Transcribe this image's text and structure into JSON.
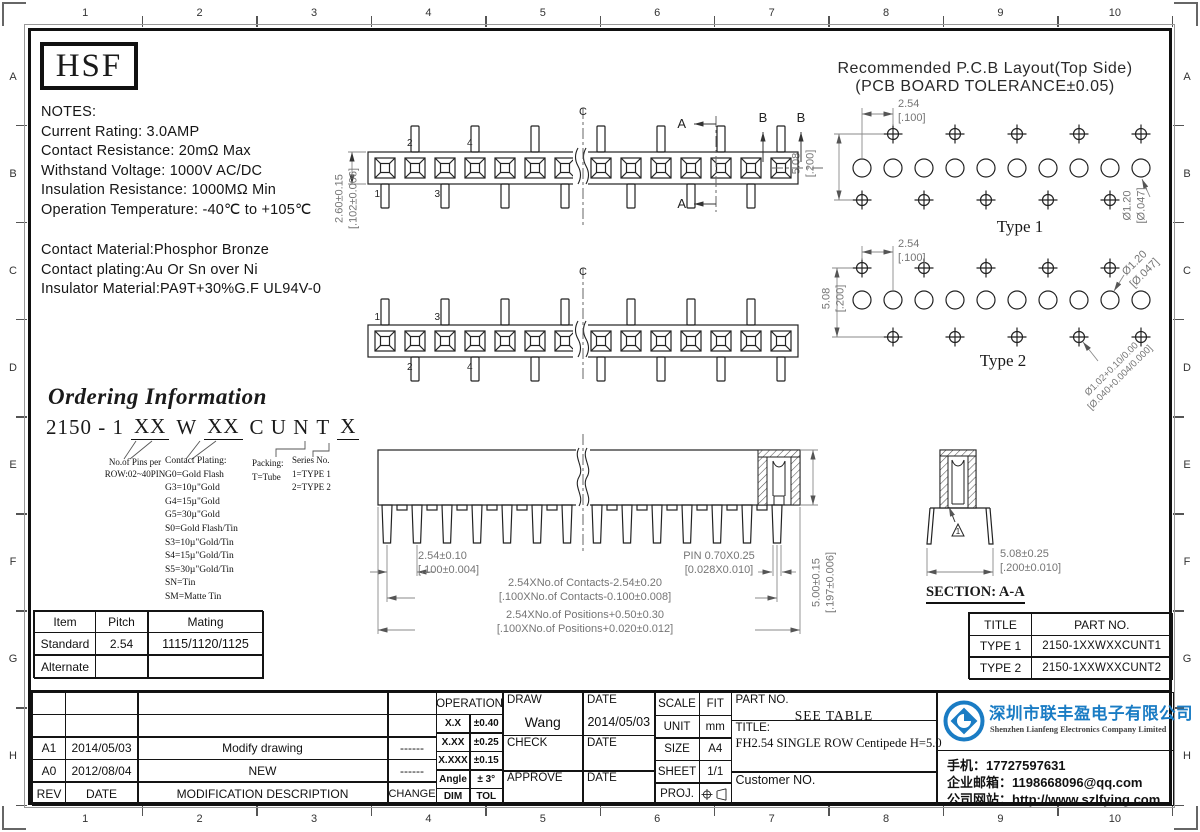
{
  "ruler": {
    "cols": [
      "1",
      "2",
      "3",
      "4",
      "5",
      "6",
      "7",
      "8",
      "9",
      "10"
    ],
    "rows": [
      "A",
      "B",
      "C",
      "D",
      "E",
      "F",
      "G",
      "H"
    ]
  },
  "logo_text": "HSF",
  "notes": {
    "heading": "NOTES:",
    "lines": [
      "Current Rating: 3.0AMP",
      "Contact Resistance: 20mΩ Max",
      "Withstand Voltage: 1000V AC/DC",
      "Insulation Resistance: 1000MΩ Min",
      "Operation Temperature: -40℃ to +105℃"
    ],
    "materials": [
      "Contact Material:Phosphor Bronze",
      "Contact plating:Au Or Sn over Ni",
      "Insulator Material:PA9T+30%G.F UL94V-0"
    ]
  },
  "pcb": {
    "title": "Recommended P.C.B Layout(Top Side)",
    "subtitle": "(PCB BOARD TOLERANCE±0.05)",
    "type1": {
      "label": "Type 1",
      "pitch": "2.54",
      "pitch_in": "[.100]",
      "row": "5.08",
      "row_in": "[.200]",
      "hole": "Ø1.20",
      "hole_in": "[Ø.047]"
    },
    "type2": {
      "label": "Type 2",
      "pitch": "2.54",
      "pitch_in": "[.100]",
      "row": "5.08",
      "row_in": "[.200]",
      "hole": "Ø1.20",
      "hole_in": "[Ø.047]",
      "hole2": "Ø1.02+0.10/0.00",
      "hole2_in": "[Ø.040+0.004/0.000]"
    }
  },
  "views": {
    "v1": {
      "height": "2.60±0.15",
      "height_in": "[.102±0.006]",
      "pins_top": [
        "2",
        "4"
      ],
      "pins_bottom": [
        "1",
        "3"
      ],
      "cl": "C",
      "sa": "A",
      "sb": "B"
    },
    "v2": {
      "pins_top": [
        "1",
        "3"
      ],
      "pins_bottom": [
        "2",
        "4"
      ],
      "cl": "C"
    }
  },
  "ordering": {
    "title": "Ordering Information",
    "code": [
      "2150 - 1",
      "XX",
      "W",
      "XX",
      "C U N",
      "T",
      "X"
    ],
    "pins_note": [
      "No.of Pins per",
      "ROW:02~40PIN"
    ],
    "plating_heading": "Contact Plating:",
    "plating": [
      "G0=Gold Flash",
      "G3=10µ\"Gold",
      "G4=15µ\"Gold",
      "G5=30µ\"Gold",
      "S0=Gold Flash/Tin",
      "S3=10µ\"Gold/Tin",
      "S4=15µ\"Gold/Tin",
      "S5=30µ\"Gold/Tin",
      "SN=Tin",
      "SM=Matte Tin"
    ],
    "packing": [
      "Packing:",
      "T=Tube"
    ],
    "series": [
      "Series No.",
      "1=TYPE 1",
      "2=TYPE 2"
    ]
  },
  "front": {
    "pitch": "2.54±0.10",
    "pitch_in": "[.100±0.004]",
    "pin": "PIN 0.70X0.25",
    "pin_in": "[0.028X0.010]",
    "contacts": "2.54XNo.of Contacts-2.54±0.20",
    "contacts_in": "[.100XNo.of Contacts-0.100±0.008]",
    "positions": "2.54XNo.of Positions+0.50±0.30",
    "positions_in": "[.100XNo.of Positions+0.020±0.012]",
    "height": "5.00±0.15",
    "height_in": "[.197±0.006]"
  },
  "section": {
    "label": "SECTION: A-A",
    "dim": "5.08±0.25",
    "dim_in": "[.200±0.010]",
    "rev": "1"
  },
  "mating_table": {
    "headers": [
      "Item",
      "Pitch",
      "Mating"
    ],
    "rows": [
      [
        "Standard",
        "2.54",
        "1115/1120/1125"
      ],
      [
        "Alternate",
        "",
        ""
      ]
    ]
  },
  "part_table": {
    "headers": [
      "TITLE",
      "PART NO."
    ],
    "rows": [
      [
        "TYPE 1",
        "2150-1XXWXXCUNT1"
      ],
      [
        "TYPE 2",
        "2150-1XXWXXCUNT2"
      ]
    ]
  },
  "revisions": {
    "rows": [
      [
        "A1",
        "2014/05/03",
        "Modify drawing",
        "------"
      ],
      [
        "A0",
        "2012/08/04",
        "NEW",
        "------"
      ]
    ],
    "footer": [
      "REV",
      "DATE",
      "MODIFICATION DESCRIPTION",
      "CHANGE"
    ]
  },
  "tolerance": {
    "header": "OPERATION",
    "rows": [
      [
        "X.X",
        "±0.40"
      ],
      [
        "X.XX",
        "±0.25"
      ],
      [
        "X.XXX",
        "±0.15"
      ],
      [
        "Angle",
        "± 3°"
      ]
    ],
    "footer": [
      "DIM",
      "TOL"
    ]
  },
  "sign": {
    "draw": "DRAW",
    "draw_name": "Wang",
    "date": "DATE",
    "draw_date": "2014/05/03",
    "check": "CHECK",
    "approve": "APPROVE"
  },
  "info": {
    "scale": "SCALE",
    "scale_v": "FIT",
    "unit": "UNIT",
    "unit_v": "mm",
    "size": "SIZE",
    "size_v": "A4",
    "sheet": "SHEET",
    "sheet_v": "1/1",
    "proj": "PROJ."
  },
  "titleblock": {
    "part_label": "PART NO.",
    "part_value": "SEE TABLE",
    "title_label": "TITLE:",
    "title_value": "FH2.54 SINGLE ROW Centipede H=5.0",
    "customer": "Customer NO."
  },
  "company": {
    "name_cn": "深圳市联丰盈电子有限公司",
    "name_en": "Shenzhen Lianfeng Electronics Company Limited",
    "phone": "手机：17727597631",
    "email": "企业邮箱：1198668096@qq.com",
    "website": "公司网站：http://www.szlfying.com",
    "accent": "#1a7cc4"
  }
}
